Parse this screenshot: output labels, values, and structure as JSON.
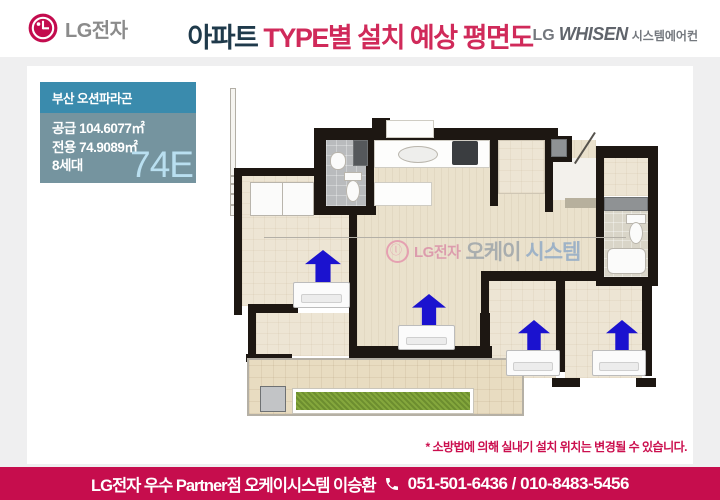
{
  "header": {
    "logo_text": "LG전자",
    "title_part1": "아파트",
    "title_part2": " TYPE별 설치 예상 평면도",
    "brand_right": {
      "lg": "LG",
      "whisen": "WHISEN",
      "suffix": "시스템에어컨"
    }
  },
  "info_box": {
    "complex_name": "부산 오션파라곤",
    "supply_area": "공급 104.6077㎡",
    "exclusive_area": "전용 74.9089㎡",
    "households": "8세대",
    "type_label": "74E"
  },
  "floorplan": {
    "watermark": {
      "lg": "LG전자",
      "word1": "오케이",
      "word2": "시스템"
    },
    "ac_indoor_unit_count": 4,
    "arrow_color": "#1b12cf"
  },
  "disclaimer": "* 소방법에 의해 실내기 설치 위치는 변경될 수 있습니다.",
  "footer": {
    "dealer": "LG전자 우수 Partner점 오케이시스템  이승환",
    "phone": "051-501-6436 / 010-8483-5456"
  },
  "colors": {
    "page_bg": "#efeff0",
    "header_bg": "#ffffff",
    "title_navy": "#1f3a4b",
    "title_pink": "#d02a5a",
    "lg_brand_red": "#c30c4e",
    "info_header_bg": "#3a8bad",
    "info_body_bg": "#75949f",
    "type_label_color": "#b9dff0",
    "footer_bg": "#c60d4d",
    "disclaimer_color": "#cb0f4e",
    "wall_color": "#1d1712"
  }
}
